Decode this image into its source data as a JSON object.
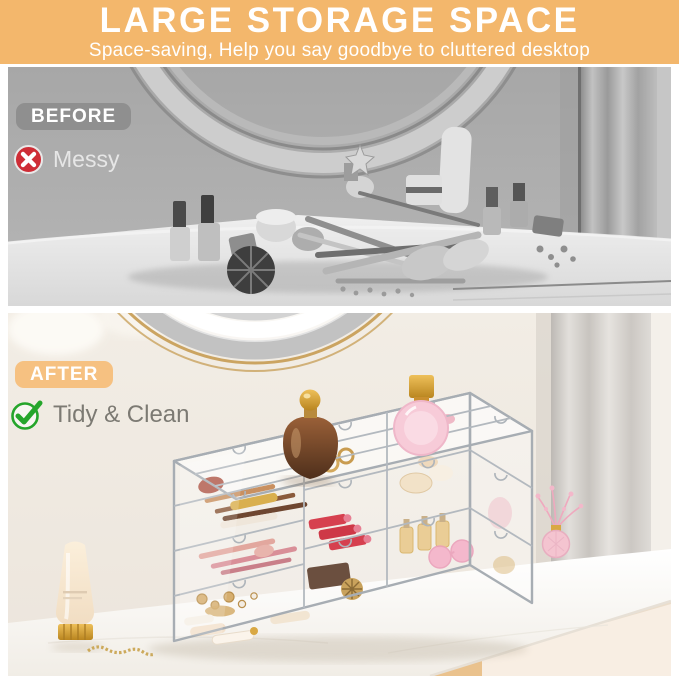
{
  "header": {
    "title": "LARGE STORAGE SPACE",
    "subtitle": "Space-saving, Help you say goodbye to cluttered desktop",
    "background_color": "#F3B76C",
    "text_color": "#FFFFFF"
  },
  "before_section": {
    "badge_label": "BEFORE",
    "badge_background": "#8F8F8F",
    "caption": "Messy",
    "caption_color": "#E6E6E6",
    "icon": "x-circle-icon",
    "icon_color": "#CE2D36",
    "photo_style": "grayscale vanity desk with cluttered makeup"
  },
  "after_section": {
    "badge_label": "AFTER",
    "badge_background": "#F6C181",
    "caption": "Tidy & Clean",
    "caption_color": "#7C7A73",
    "icon": "check-circle-icon",
    "icon_color": "#25A52B",
    "photo_style": "color vanity desk with clear acrylic drawer organizer holding makeup"
  }
}
